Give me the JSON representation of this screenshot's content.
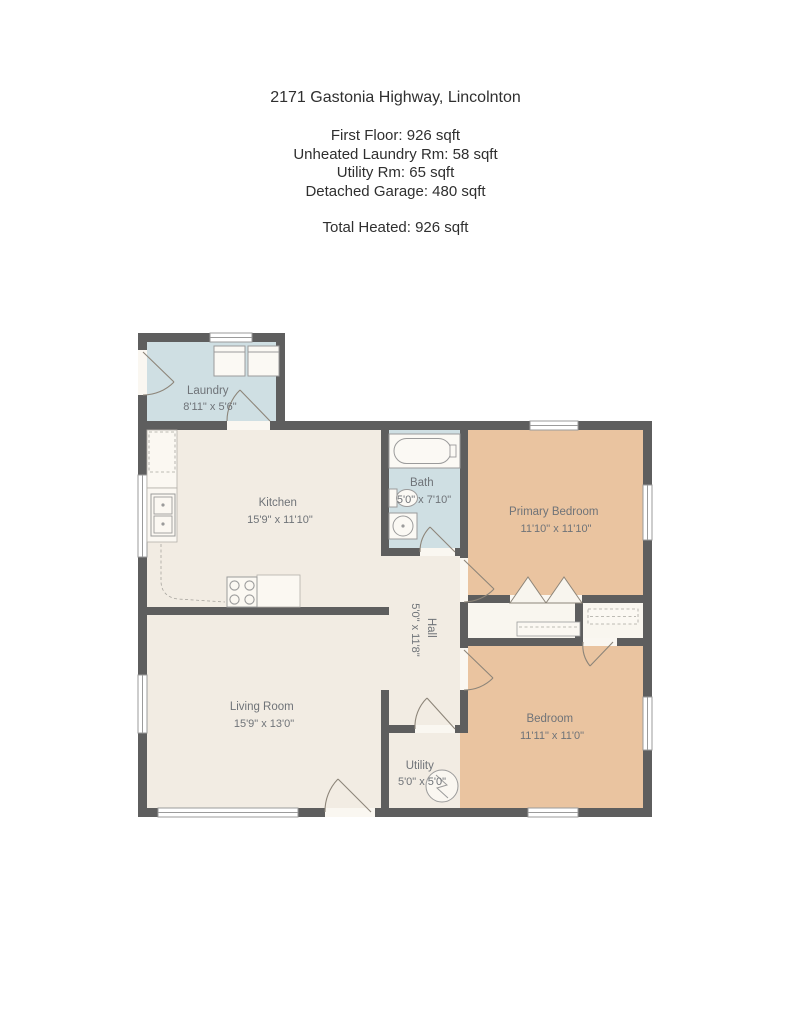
{
  "header": {
    "address": "2171 Gastonia Highway, Lincolnton",
    "stats": [
      "First Floor: 926 sqft",
      "Unheated Laundry Rm: 58 sqft",
      "Utility Rm: 65 sqft",
      "Detached Garage: 480 sqft"
    ],
    "total": "Total Heated: 926 sqft"
  },
  "floorplan": {
    "colors": {
      "wall": "#5e5e5e",
      "floor_main": "#f2ece3",
      "floor_wet": "#cfdfe3",
      "floor_bedroom": "#eac4a0",
      "floor_closet": "#f9f6ef",
      "fixture_fill": "#fbf9f4",
      "fixture_stroke": "#9b9b9b",
      "door_stroke": "#8d8579",
      "label": "#6f7378"
    },
    "rooms": [
      {
        "id": "laundry",
        "name": "Laundry",
        "dims": "8'11\" x 5'6\""
      },
      {
        "id": "kitchen",
        "name": "Kitchen",
        "dims": "15'9\" x 11'10\""
      },
      {
        "id": "bath",
        "name": "Bath",
        "dims": "5'0\" x 7'10\""
      },
      {
        "id": "primary-bedroom",
        "name": "Primary Bedroom",
        "dims": "11'10\" x 11'10\""
      },
      {
        "id": "hall",
        "name": "Hall",
        "dims": "5'0\" x 11'8\""
      },
      {
        "id": "living-room",
        "name": "Living Room",
        "dims": "15'9\" x 13'0\""
      },
      {
        "id": "utility",
        "name": "Utility",
        "dims": "5'0\" x 5'0\""
      },
      {
        "id": "bedroom",
        "name": "Bedroom",
        "dims": "11'11\" x 11'0\""
      }
    ],
    "fixtures": [
      "washer",
      "dryer",
      "kitchen-sink",
      "stove",
      "bathtub",
      "toilet",
      "bath-sink",
      "water-heater",
      "closet-shelves",
      "bifold-doors"
    ]
  }
}
